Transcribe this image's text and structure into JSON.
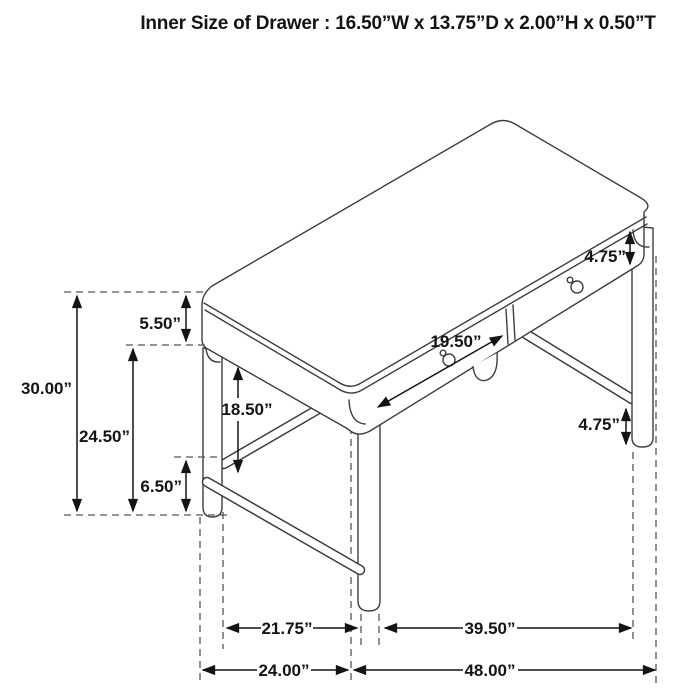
{
  "title": "Inner Size of Drawer : 16.50”W x 13.75”D x 2.00”H x 0.50”T",
  "figure": {
    "type": "technical-dimension-diagram",
    "subject": "2-drawer writing desk, isometric line drawing",
    "dimensions": {
      "overall_height": "30.00”",
      "top_and_apron_height": "5.50”",
      "floor_to_apron": "24.50”",
      "floor_to_stretcher": "6.50”",
      "apron_to_stretcher_clearance": "18.50”",
      "drawer_front_width": "19.50”",
      "drawer_band_height": "4.75”",
      "stretcher_to_floor_leg": "4.75”",
      "side_leg_spacing": "21.75”",
      "front_leg_spacing": "39.50”",
      "overall_depth": "24.00”",
      "overall_width": "48.00”"
    }
  },
  "colors": {
    "line": "#3d3d3d",
    "dimension": "#141414",
    "dashed_guide": "#565656",
    "background": "#ffffff"
  }
}
